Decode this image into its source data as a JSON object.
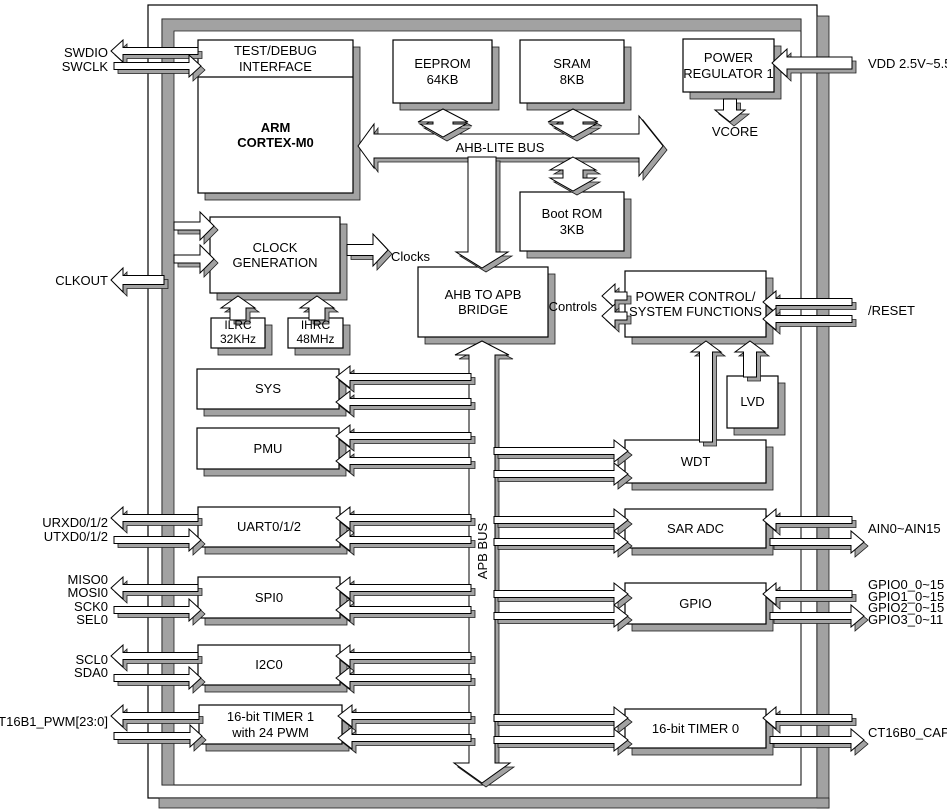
{
  "diagram": {
    "blocks": {
      "test_debug": "TEST/DEBUG\nINTERFACE",
      "arm": "ARM\nCORTEX-M0",
      "eeprom": "EEPROM\n64KB",
      "sram": "SRAM\n8KB",
      "power_regulator": "POWER\nREGULATOR 1",
      "boot_rom": "Boot ROM\n3KB",
      "clock_generation": "CLOCK GENERATION",
      "ilrc": "ILRC\n32KHz",
      "ihrc": "IHRC\n48MHz",
      "ahb_apb_bridge": "AHB TO APB\nBRIDGE",
      "power_control": "POWER CONTROL/\nSYSTEM FUNCTIONS",
      "lvd": "LVD",
      "sys": "SYS",
      "pmu": "PMU",
      "wdt": "WDT",
      "uart": "UART0/1/2",
      "spi": "SPI0",
      "i2c": "I2C0",
      "timer1": "16-bit TIMER 1\nwith 24 PWM",
      "sar_adc": "SAR ADC",
      "gpio": "GPIO",
      "timer0": "16-bit TIMER 0"
    },
    "bus_labels": {
      "ahb": "AHB-LITE BUS",
      "apb": "APB BUS",
      "clocks": "Clocks",
      "controls": "Controls",
      "vcore": "VCORE"
    },
    "pins_left": [
      "SWDIO",
      "SWCLK",
      "CLKOUT",
      "URXD0/1/2",
      "UTXD0/1/2",
      "MISO0",
      "MOSI0",
      "SCK0",
      "SEL0",
      "SCL0",
      "SDA0",
      "CT16B1_PWM[23:0]"
    ],
    "pins_right": [
      "VDD 2.5V~5.5V",
      "/RESET",
      "AIN0~AIN15",
      "GPIO0_0~15",
      "GPIO1_0~15",
      "GPIO2_0~15",
      "GPIO3_0~11",
      "CT16B0_CAP0"
    ],
    "colors": {
      "shadow": "#a2a2a2",
      "box_fill": "#ffffff",
      "line": "#000000"
    }
  }
}
